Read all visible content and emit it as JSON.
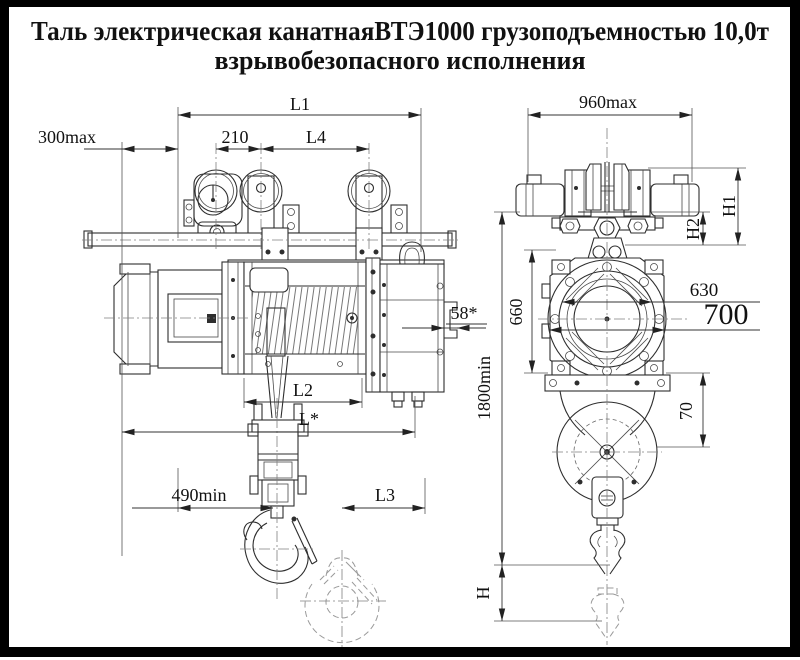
{
  "title": {
    "line1": "Таль электрическая канатнаяВТЭ1000 грузоподъемностью 10,0т",
    "line2": "взрывобезопасного исполнения"
  },
  "dimensions": {
    "side_view": {
      "l1": "L1",
      "offset_max": "300max",
      "wheel_pitch": "210",
      "l4": "L4",
      "rail_bracket": "58*",
      "l2": "L2",
      "l_star": "L*",
      "hook_min": "490min",
      "l3": "L3"
    },
    "front_view": {
      "width_max": "960max",
      "h1": "H1",
      "h2": "H2",
      "body_height": "660",
      "dia_630": "630",
      "dia_700": "700",
      "lift_min": "1800min",
      "offset_70": "70",
      "hook_stroke": "H"
    }
  },
  "colors": {
    "background": "#ffffff",
    "frame": "#000000",
    "line": "#2e2e2e",
    "dimension": "#333333",
    "ghost": "#9a9a9a"
  }
}
